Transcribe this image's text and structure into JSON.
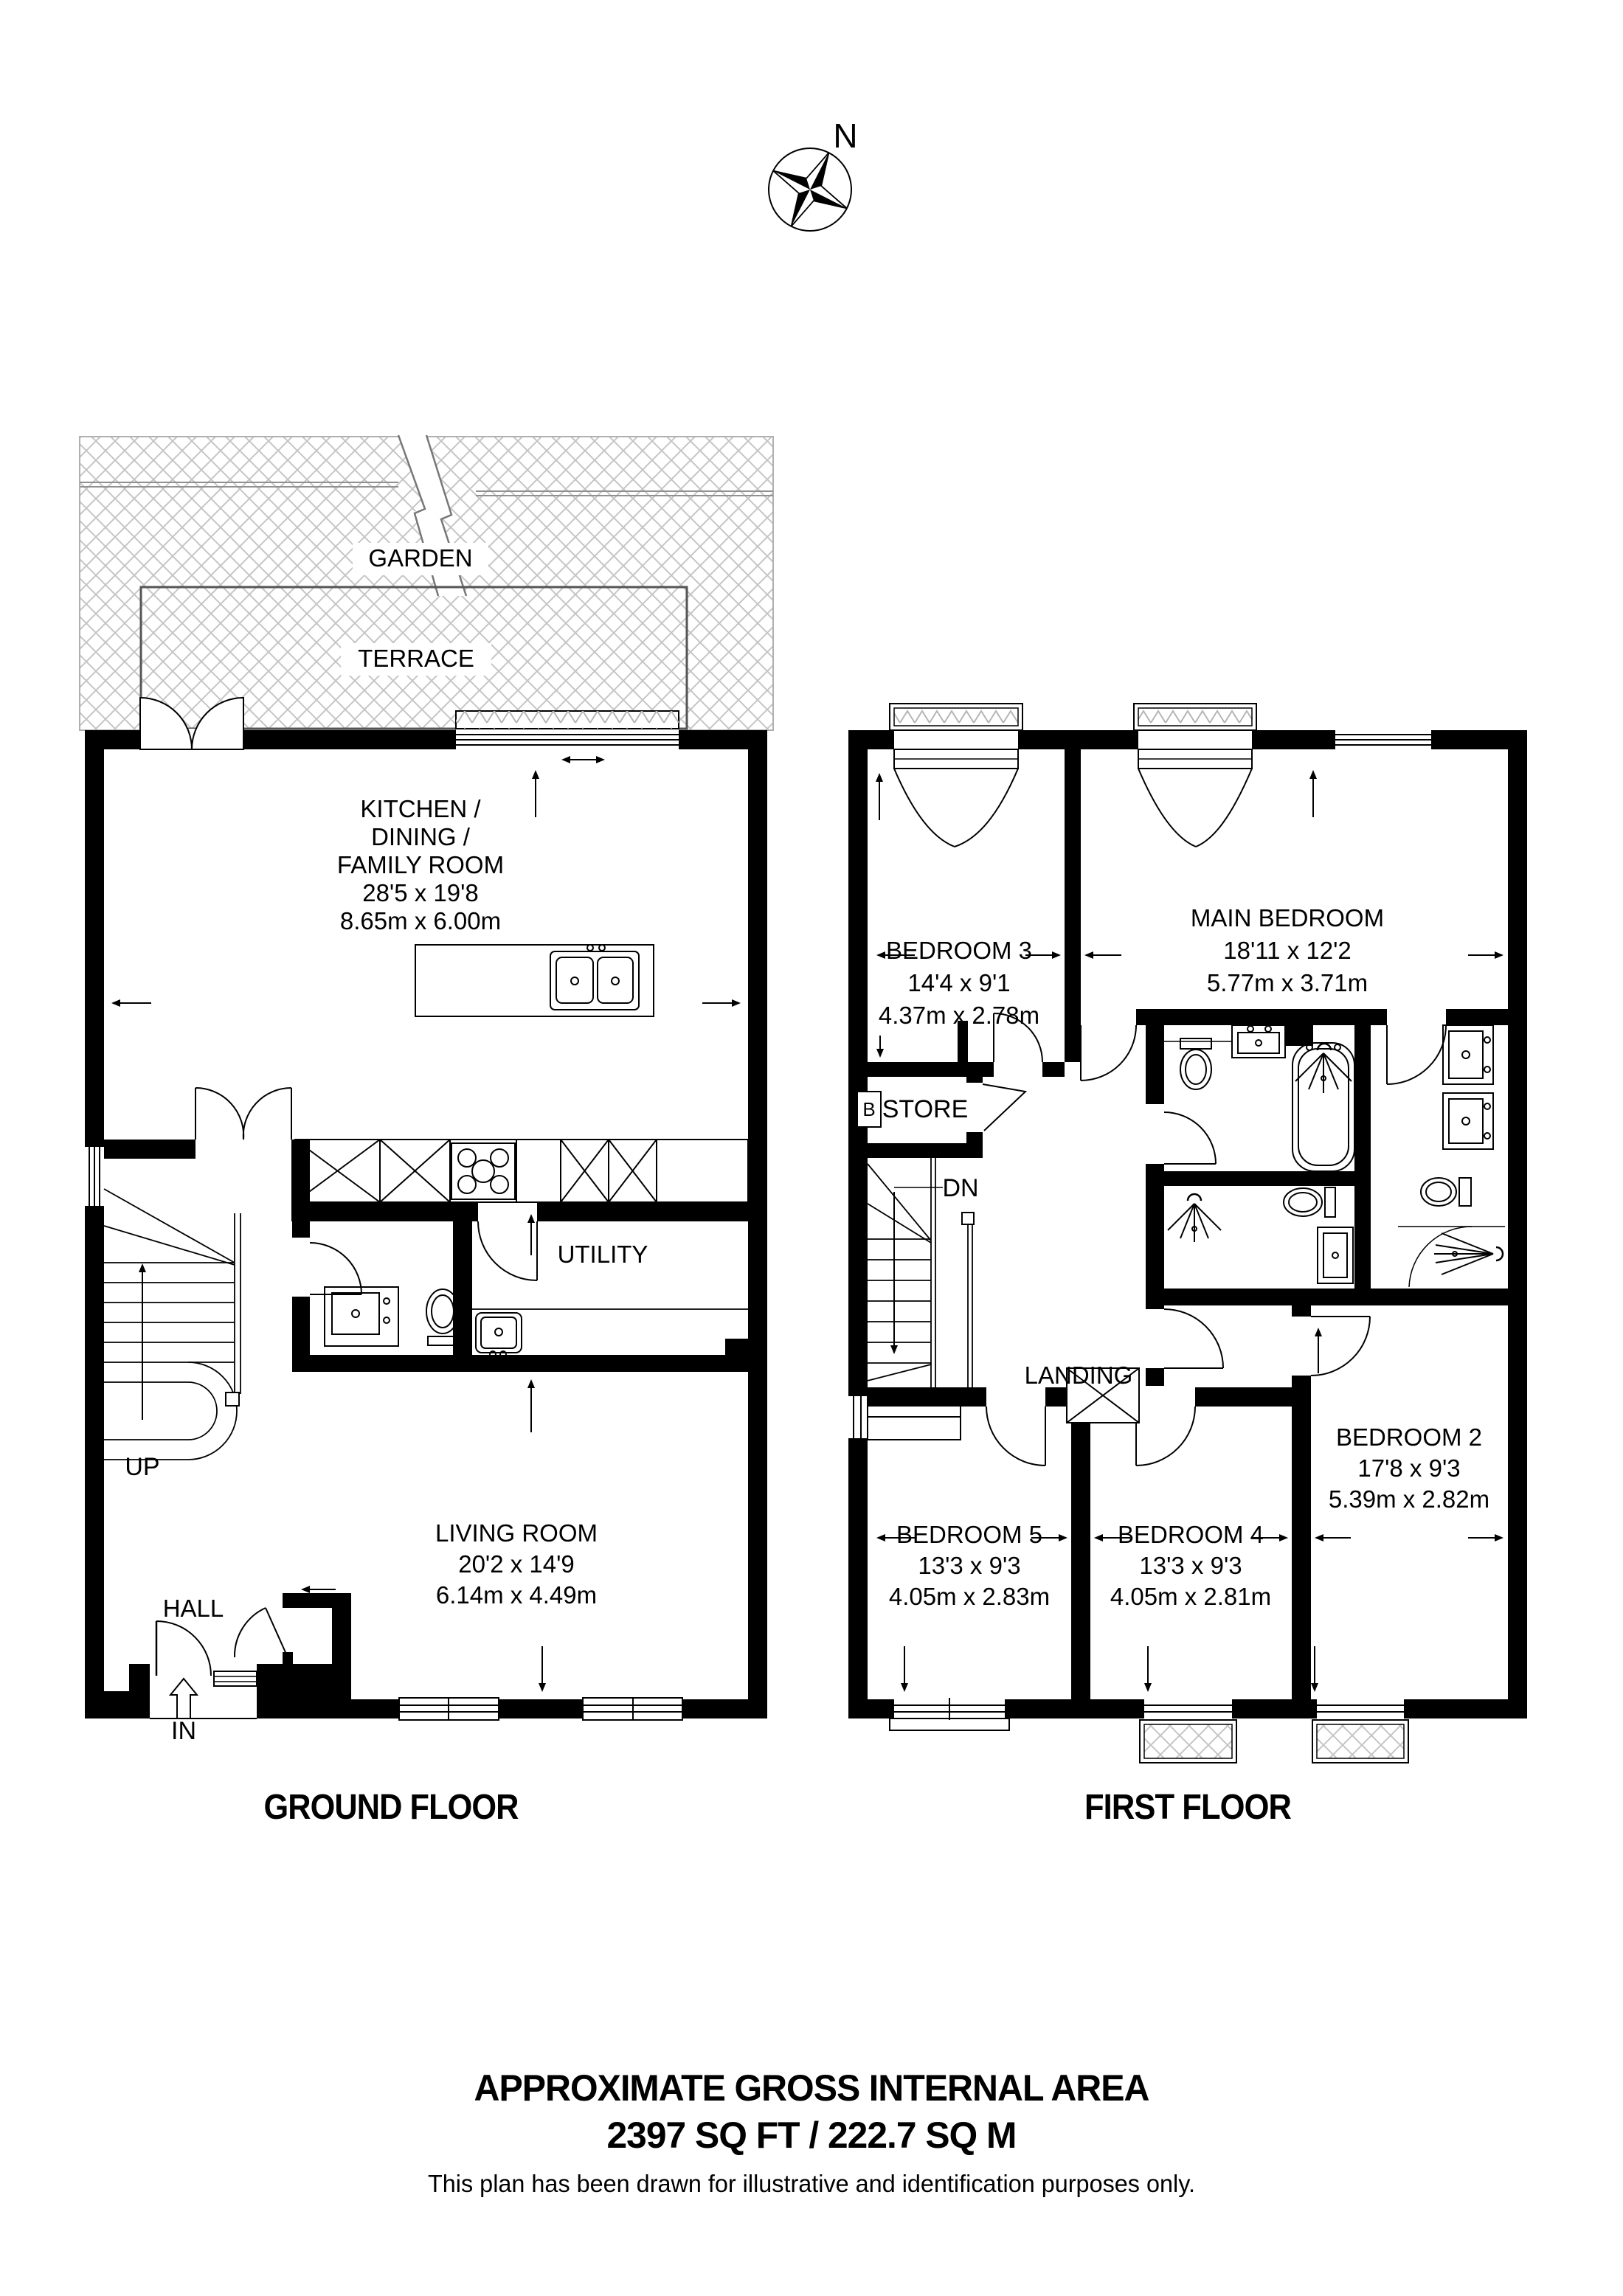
{
  "compass": {
    "north_label": "N"
  },
  "outdoor": {
    "garden_label": "GARDEN",
    "terrace_label": "TERRACE"
  },
  "ground_floor": {
    "title": "GROUND FLOOR",
    "kitchen": {
      "lines": [
        "KITCHEN /",
        "DINING /",
        "FAMILY ROOM",
        "28'5 x 19'8",
        "8.65m x 6.00m"
      ]
    },
    "utility": {
      "label": "UTILITY"
    },
    "hall": {
      "label": "HALL"
    },
    "living_room": {
      "lines": [
        "LIVING ROOM",
        "20'2 x 14'9",
        "6.14m x 4.49m"
      ]
    },
    "stairs": {
      "label": "UP"
    },
    "entrance": {
      "label": "IN"
    }
  },
  "first_floor": {
    "title": "FIRST FLOOR",
    "bedroom3": {
      "lines": [
        "BEDROOM 3",
        "14'4 x 9'1",
        "4.37m x 2.78m"
      ]
    },
    "main_bedroom": {
      "lines": [
        "MAIN BEDROOM",
        "18'11 x 12'2",
        "5.77m x 3.71m"
      ]
    },
    "store": {
      "label": "STORE",
      "boiler_label": "B"
    },
    "landing": {
      "label": "LANDING"
    },
    "stairs": {
      "label": "DN"
    },
    "bedroom5": {
      "lines": [
        "BEDROOM 5",
        "13'3 x 9'3",
        "4.05m x 2.83m"
      ]
    },
    "bedroom4": {
      "lines": [
        "BEDROOM 4",
        "13'3 x 9'3",
        "4.05m x 2.81m"
      ]
    },
    "bedroom2": {
      "lines": [
        "BEDROOM 2",
        "17'8 x 9'3",
        "5.39m x 2.82m"
      ]
    }
  },
  "footer": {
    "area_title": "APPROXIMATE GROSS INTERNAL AREA",
    "area_value": "2397 SQ FT / 222.7 SQ M",
    "disclaimer": "This plan has been drawn for illustrative and identification purposes only."
  },
  "colors": {
    "wall": "#000000",
    "hatch": "#c5c5c5",
    "background": "#ffffff"
  }
}
